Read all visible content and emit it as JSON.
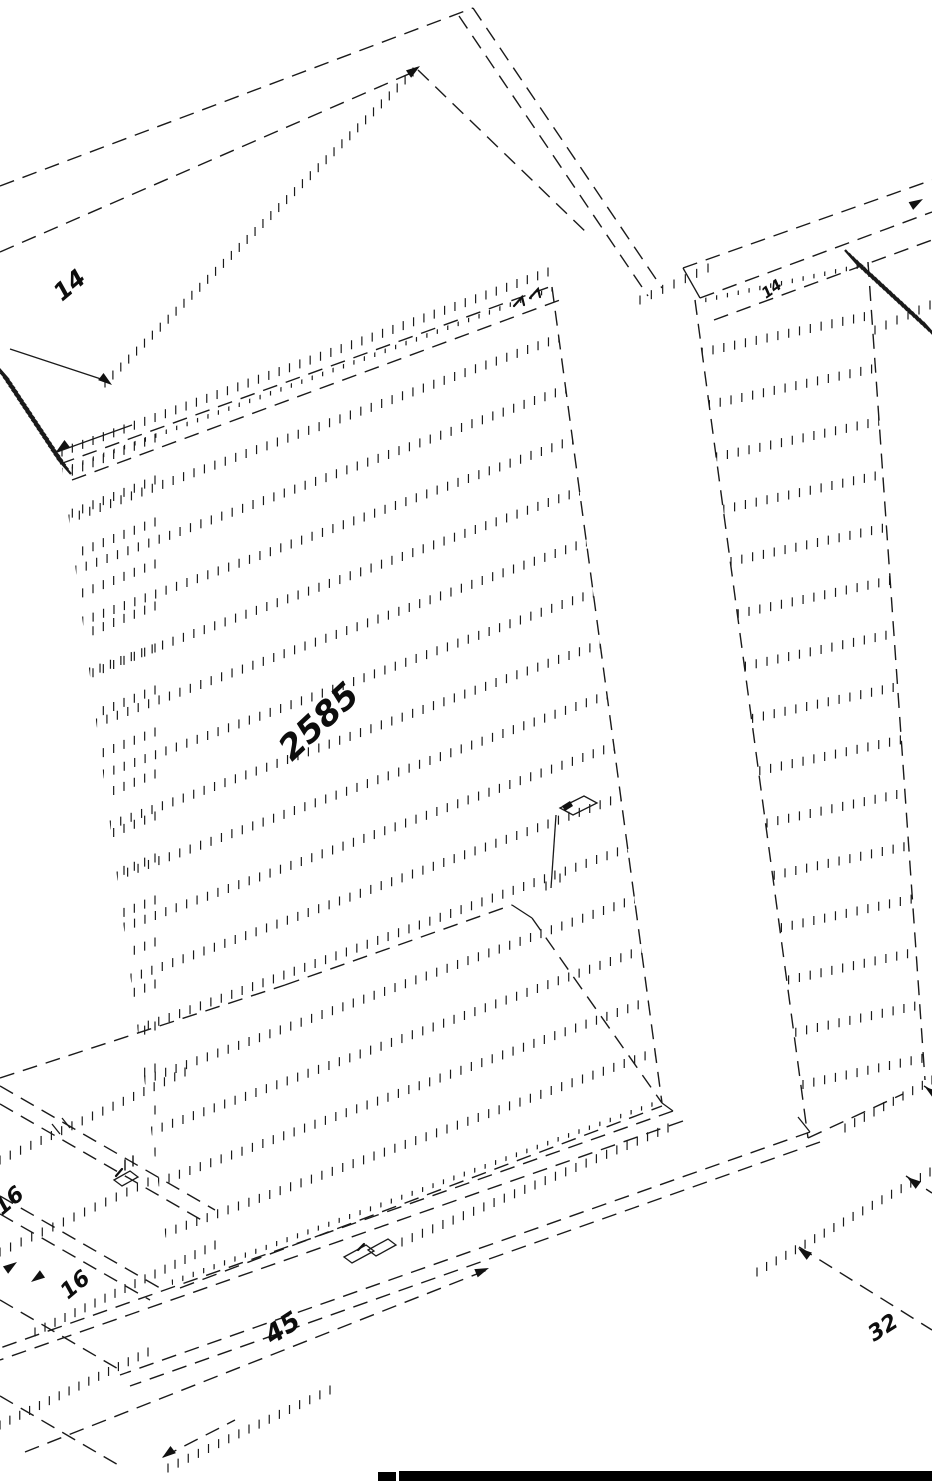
{
  "drawing": {
    "title": "isometric-cabinet-line-drawing",
    "labels": {
      "top_left": "14",
      "top_right": "14",
      "center": "2585",
      "bottom_left_upper": "16",
      "bottom_left_lower": "16",
      "bottom_center": "45",
      "bottom_right": "32"
    },
    "colors": {
      "line": "#1a1a1a",
      "background": "#ffffff",
      "bar": "#000000"
    }
  }
}
